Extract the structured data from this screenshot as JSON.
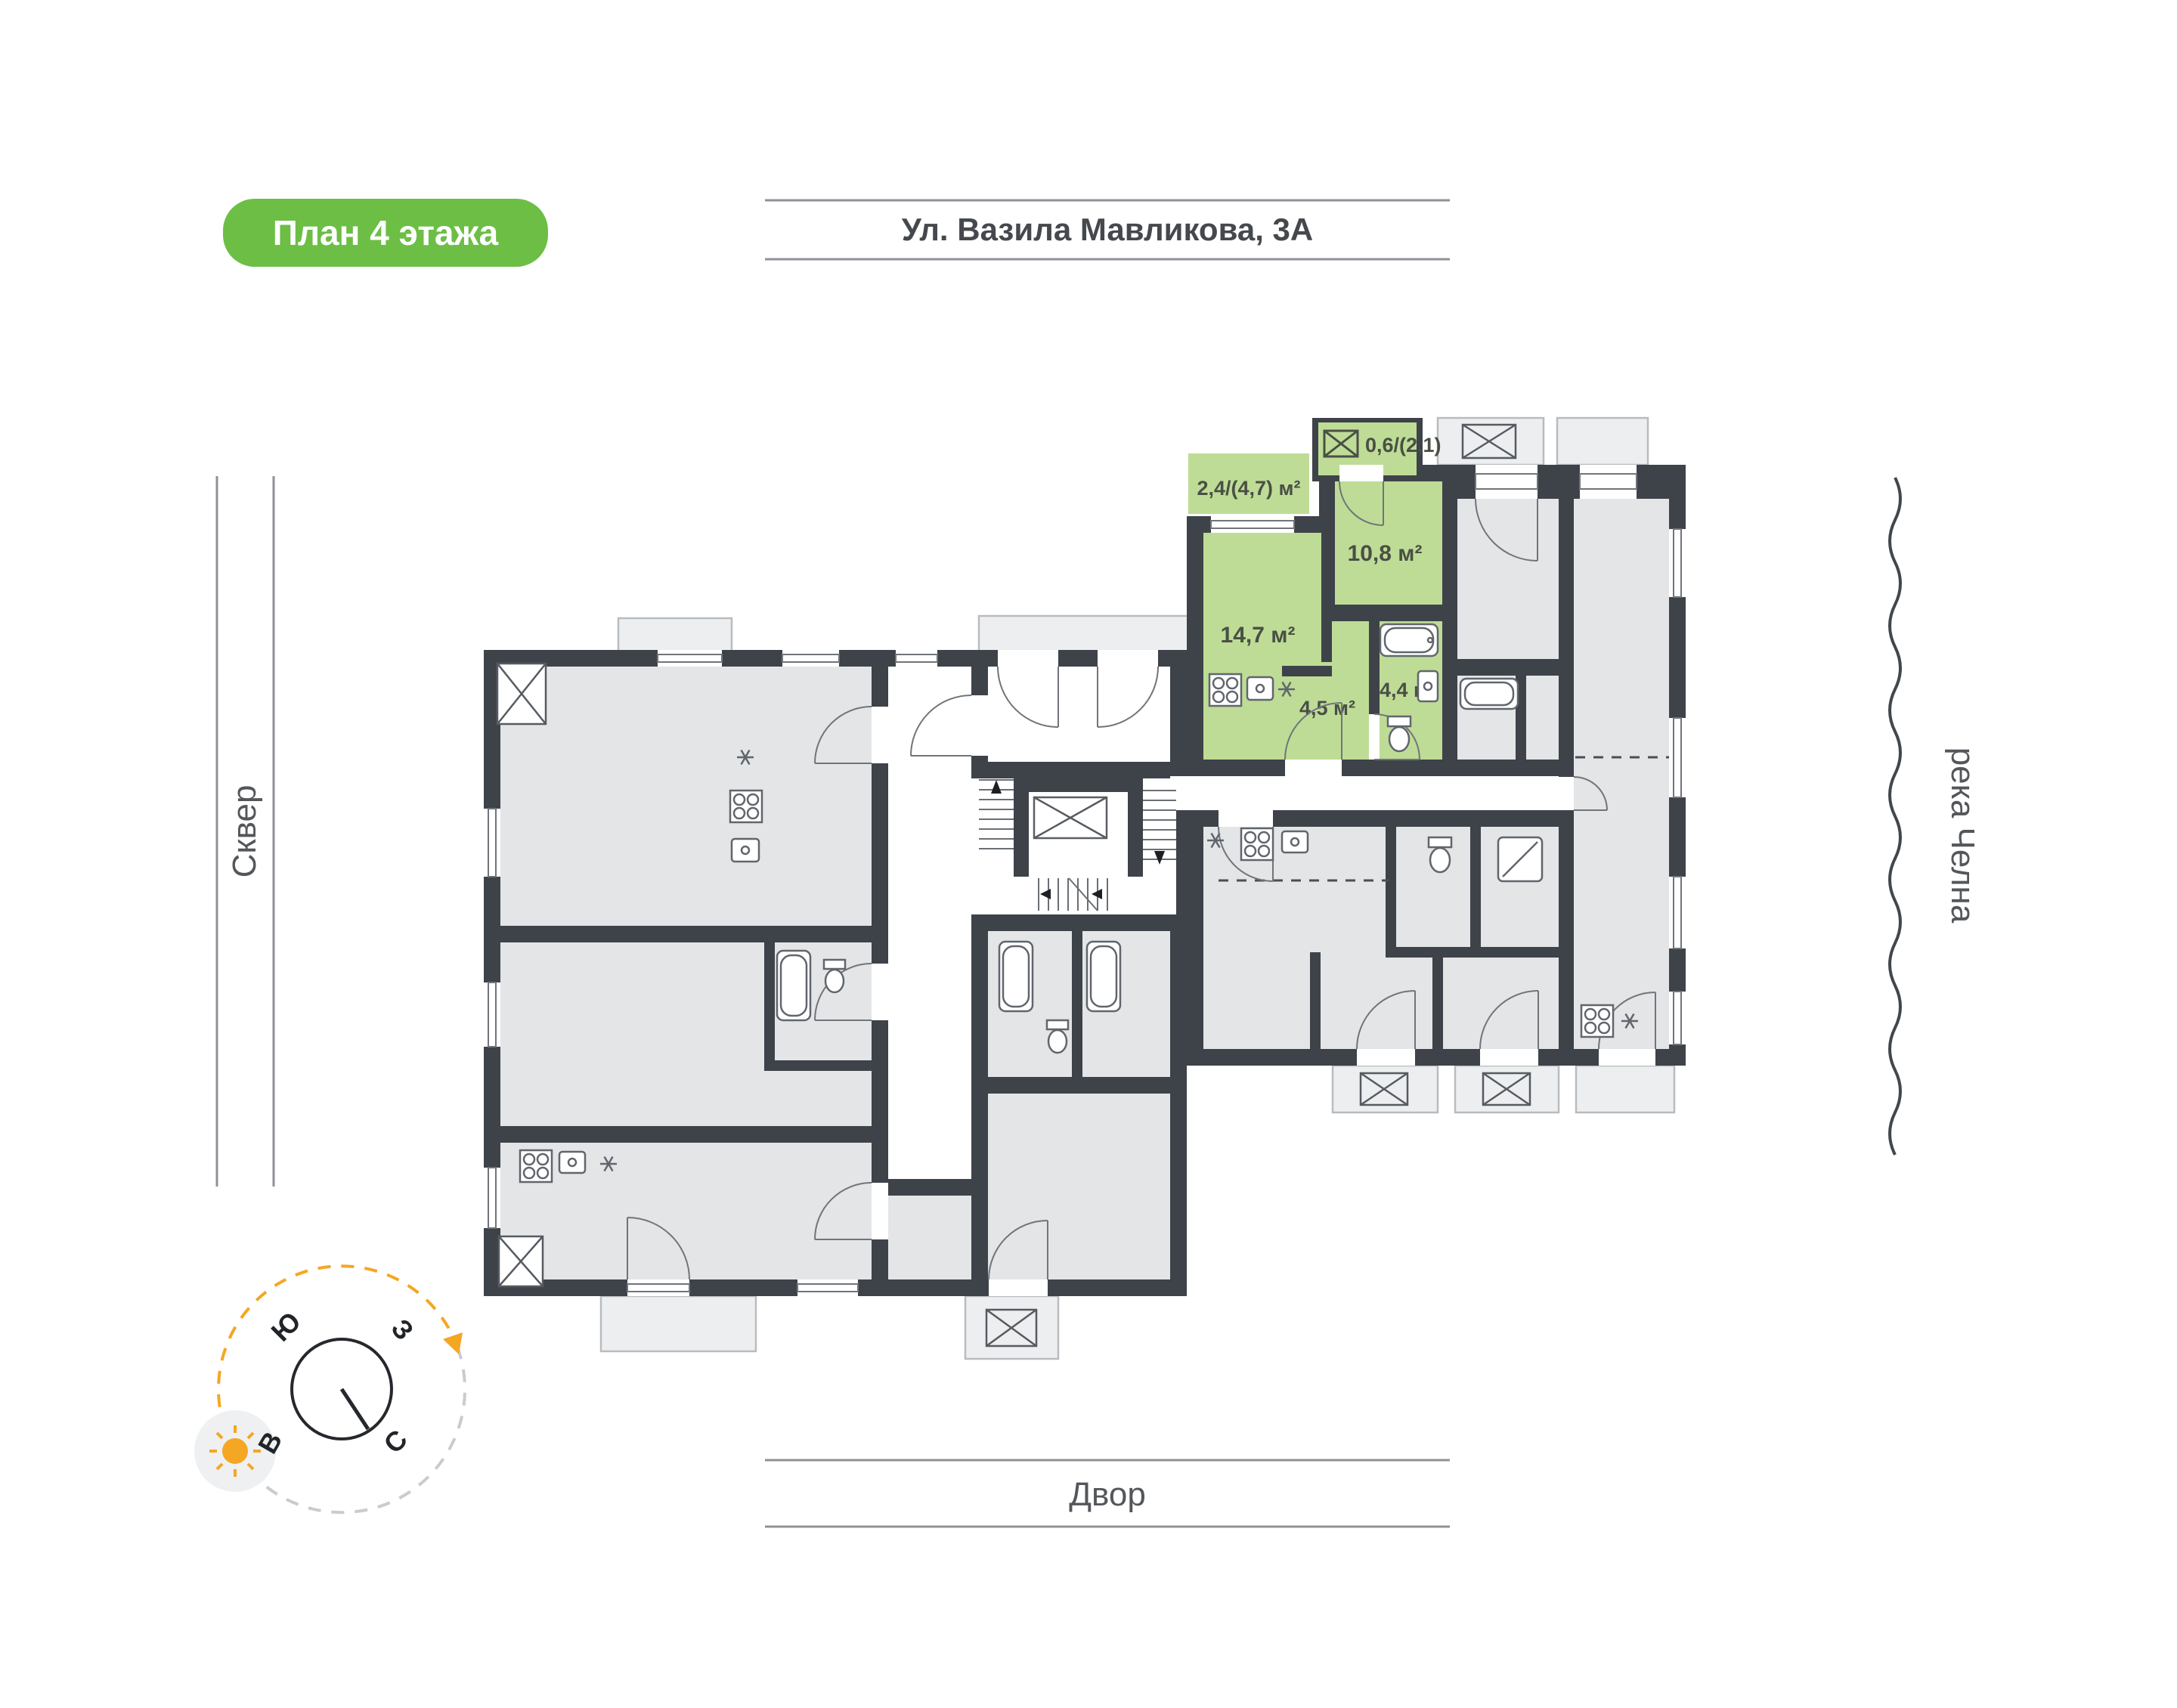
{
  "badge": {
    "label": "План 4 этажа",
    "bg": "#6cbe45"
  },
  "street": {
    "label": "Ул. Вазила Мавликова, 3А"
  },
  "sides": {
    "left": "Сквер",
    "right": "река Челна",
    "bottom": "Двор"
  },
  "compass": {
    "south": "Ю",
    "west": "З",
    "east": "В",
    "north": "С",
    "accent": "#f5a623"
  },
  "apartment": {
    "highlight_color": "#bedc96",
    "areas": {
      "balcony": "2,4/(4,7) м²",
      "loggia": "0,6/(2,1)",
      "bedroom": "10,8 м²",
      "kitchen_living": "14,7 м²",
      "hall": "4,5 м²",
      "bathroom": "4,4 м²"
    }
  },
  "colors": {
    "wall": "#3e434a",
    "room": "#e3e5e7",
    "balcony": "#eceeef",
    "accent_green": "#6cbe45"
  }
}
